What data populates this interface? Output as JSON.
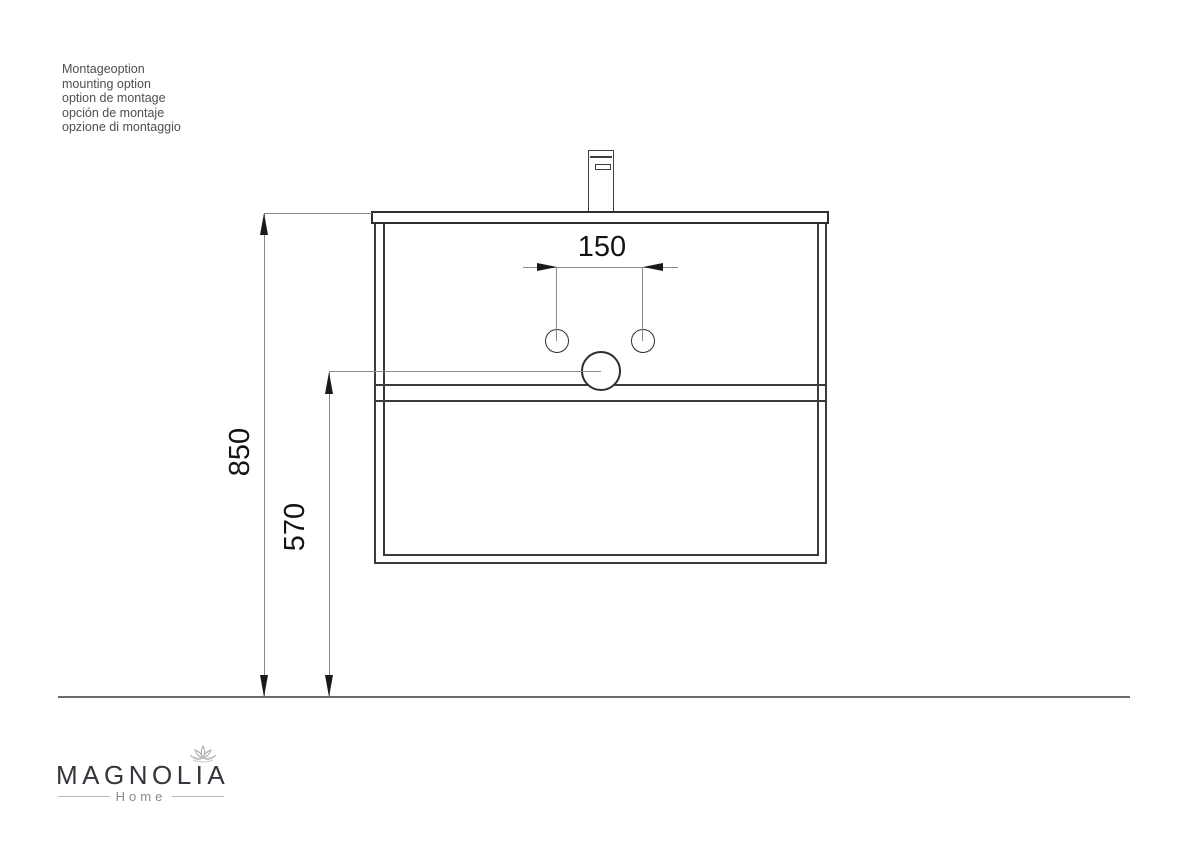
{
  "info_block": {
    "lines": [
      "Montageoption",
      "mounting option",
      "option de montage",
      "opción de montaje",
      "opzione di montaggio"
    ]
  },
  "drawing": {
    "type": "technical-drawing",
    "subject": "wall-mounted vanity with washbasin and faucet, front elevation",
    "dims": {
      "spacing": "150",
      "height_total": "850",
      "height_drain": "570"
    }
  },
  "logo": {
    "brand": "MAGNOLIA",
    "subtitle": "Home",
    "icon": "magnolia-flower-icon"
  },
  "colors": {
    "background": "#ffffff",
    "outline_dark": "#3a3a3a",
    "dimension_line": "#8a8a8a",
    "arrowhead": "#1a1a1a",
    "floor_line": "#6b6b6b",
    "dimension_text": "#131313",
    "logo_text": "#35353d",
    "logo_subtitle": "#8a8a8a"
  }
}
